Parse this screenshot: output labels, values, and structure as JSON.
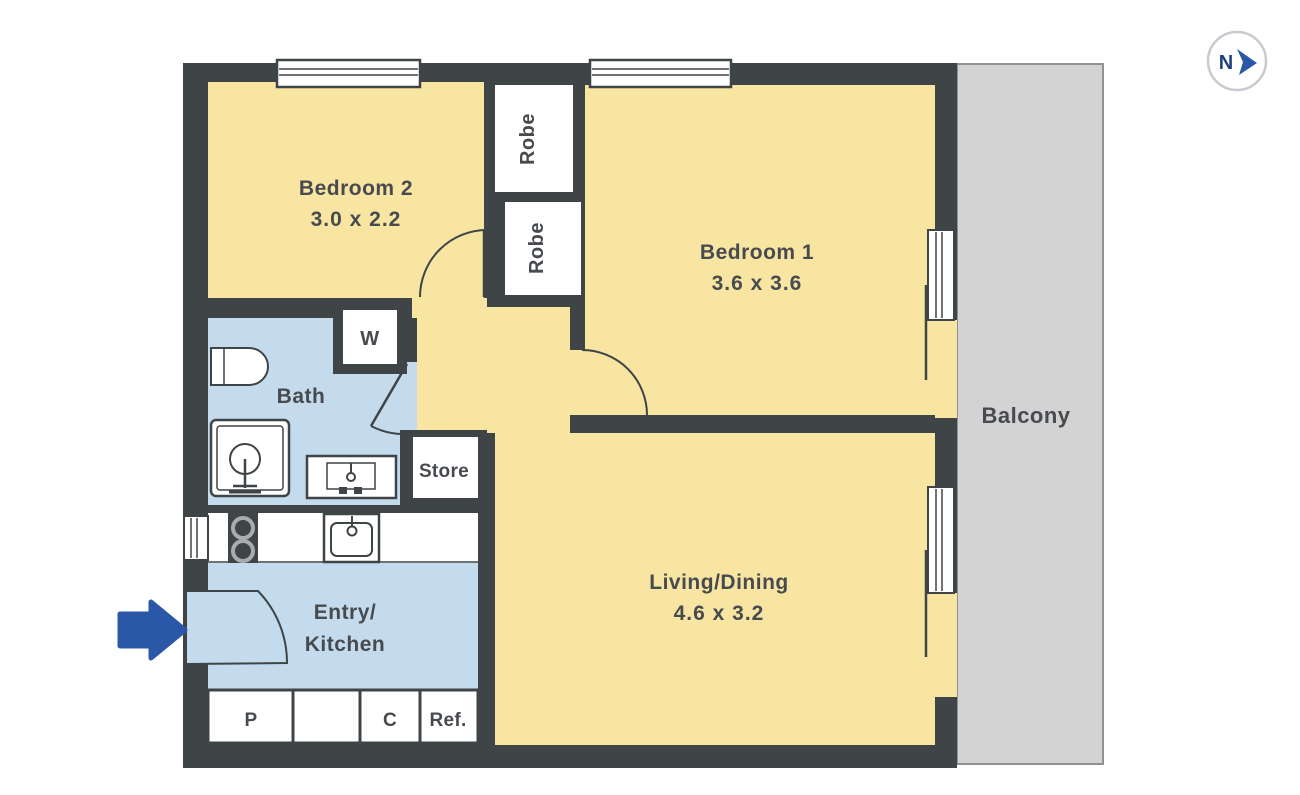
{
  "plan": {
    "compass": {
      "label": "N"
    },
    "rooms": {
      "bedroom2": {
        "name": "Bedroom 2",
        "dims": "3.0 x 2.2"
      },
      "bedroom1": {
        "name": "Bedroom 1",
        "dims": "3.6 x 3.6"
      },
      "living_dining": {
        "name": "Living/Dining",
        "dims": "4.6 x 3.2"
      },
      "bath": {
        "name": "Bath"
      },
      "entry_kitchen": {
        "name_line1": "Entry/",
        "name_line2": "Kitchen"
      },
      "balcony": {
        "name": "Balcony"
      }
    },
    "storage": {
      "robe_top": "Robe",
      "robe_bottom": "Robe",
      "washer": "W",
      "store": "Store",
      "pantry": "P",
      "cupboard": "C",
      "fridge": "Ref."
    },
    "colors": {
      "wall": "#3F4447",
      "room": "#F8E5A1",
      "wet": "#C3DBEC",
      "balcony": "#D3D3D3",
      "accent": "#2B57A8",
      "label": "#474B4F",
      "compassN": "#1F3F7E",
      "ring": "#C7CBD0"
    }
  }
}
